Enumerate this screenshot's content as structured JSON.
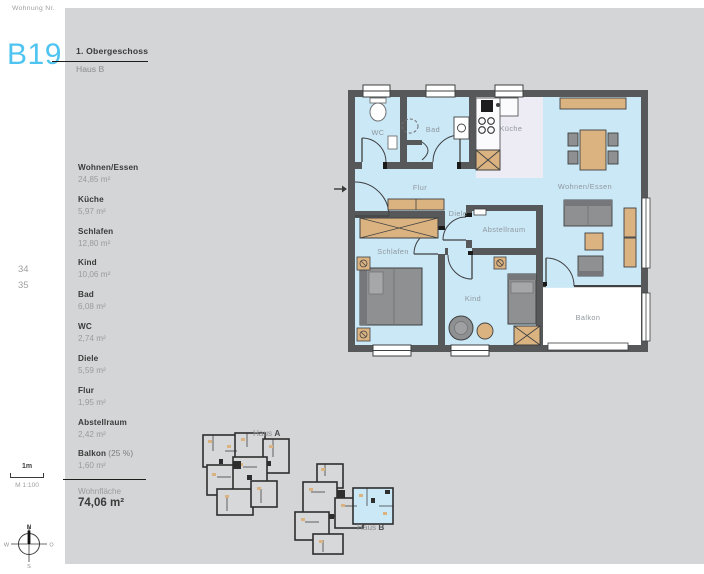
{
  "header": {
    "label": "Wohnung Nr.",
    "unit": "B19",
    "floor": "1. Obergeschoss",
    "house": "Haus B"
  },
  "page_numbers": {
    "first": "34",
    "second": "35"
  },
  "room_list": {
    "items": [
      {
        "name": "Wohnen/Essen",
        "area": "24,85 m²"
      },
      {
        "name": "Küche",
        "area": "5,97 m²"
      },
      {
        "name": "Schlafen",
        "area": "12,80 m²"
      },
      {
        "name": "Kind",
        "area": "10,06 m²"
      },
      {
        "name": "Bad",
        "area": "6,08 m²"
      },
      {
        "name": "WC",
        "area": "2,74 m²"
      },
      {
        "name": "Diele",
        "area": "5,59 m²"
      },
      {
        "name": "Flur",
        "area": "1,95 m²"
      },
      {
        "name": "Abstellraum",
        "area": "2,42 m²"
      },
      {
        "name": "Balkon",
        "suffix": "(25 %)",
        "area": "1,60 m²"
      }
    ],
    "total_label": "Wohnfläche",
    "total_value": "74,06 m²"
  },
  "scale": {
    "bar": "1m",
    "ratio": "M 1:100"
  },
  "compass": {
    "north": "N",
    "east": "O",
    "south": "S",
    "west": "W"
  },
  "plan": {
    "labels": {
      "wc": "WC",
      "bad": "Bad",
      "kueche": "Küche",
      "flur": "Flur",
      "diele": "Diele",
      "abstellraum": "Abstellraum",
      "wohnen_essen": "Wohnen/Essen",
      "schlafen": "Schlafen",
      "kind": "Kind",
      "balkon": "Balkon"
    }
  },
  "keyplans": {
    "haus_a": {
      "prefix": "Haus ",
      "letter": "A"
    },
    "haus_b": {
      "prefix": "Haus ",
      "letter": "B"
    }
  },
  "colors": {
    "accent": "#4fc4f0",
    "panel": "#d3d5d7",
    "room_fill": "#cbe8f7",
    "wall": "#57585a",
    "wood": "#dbb381",
    "furniture": "#8f9091",
    "kitchen_floor": "#edecf4"
  }
}
